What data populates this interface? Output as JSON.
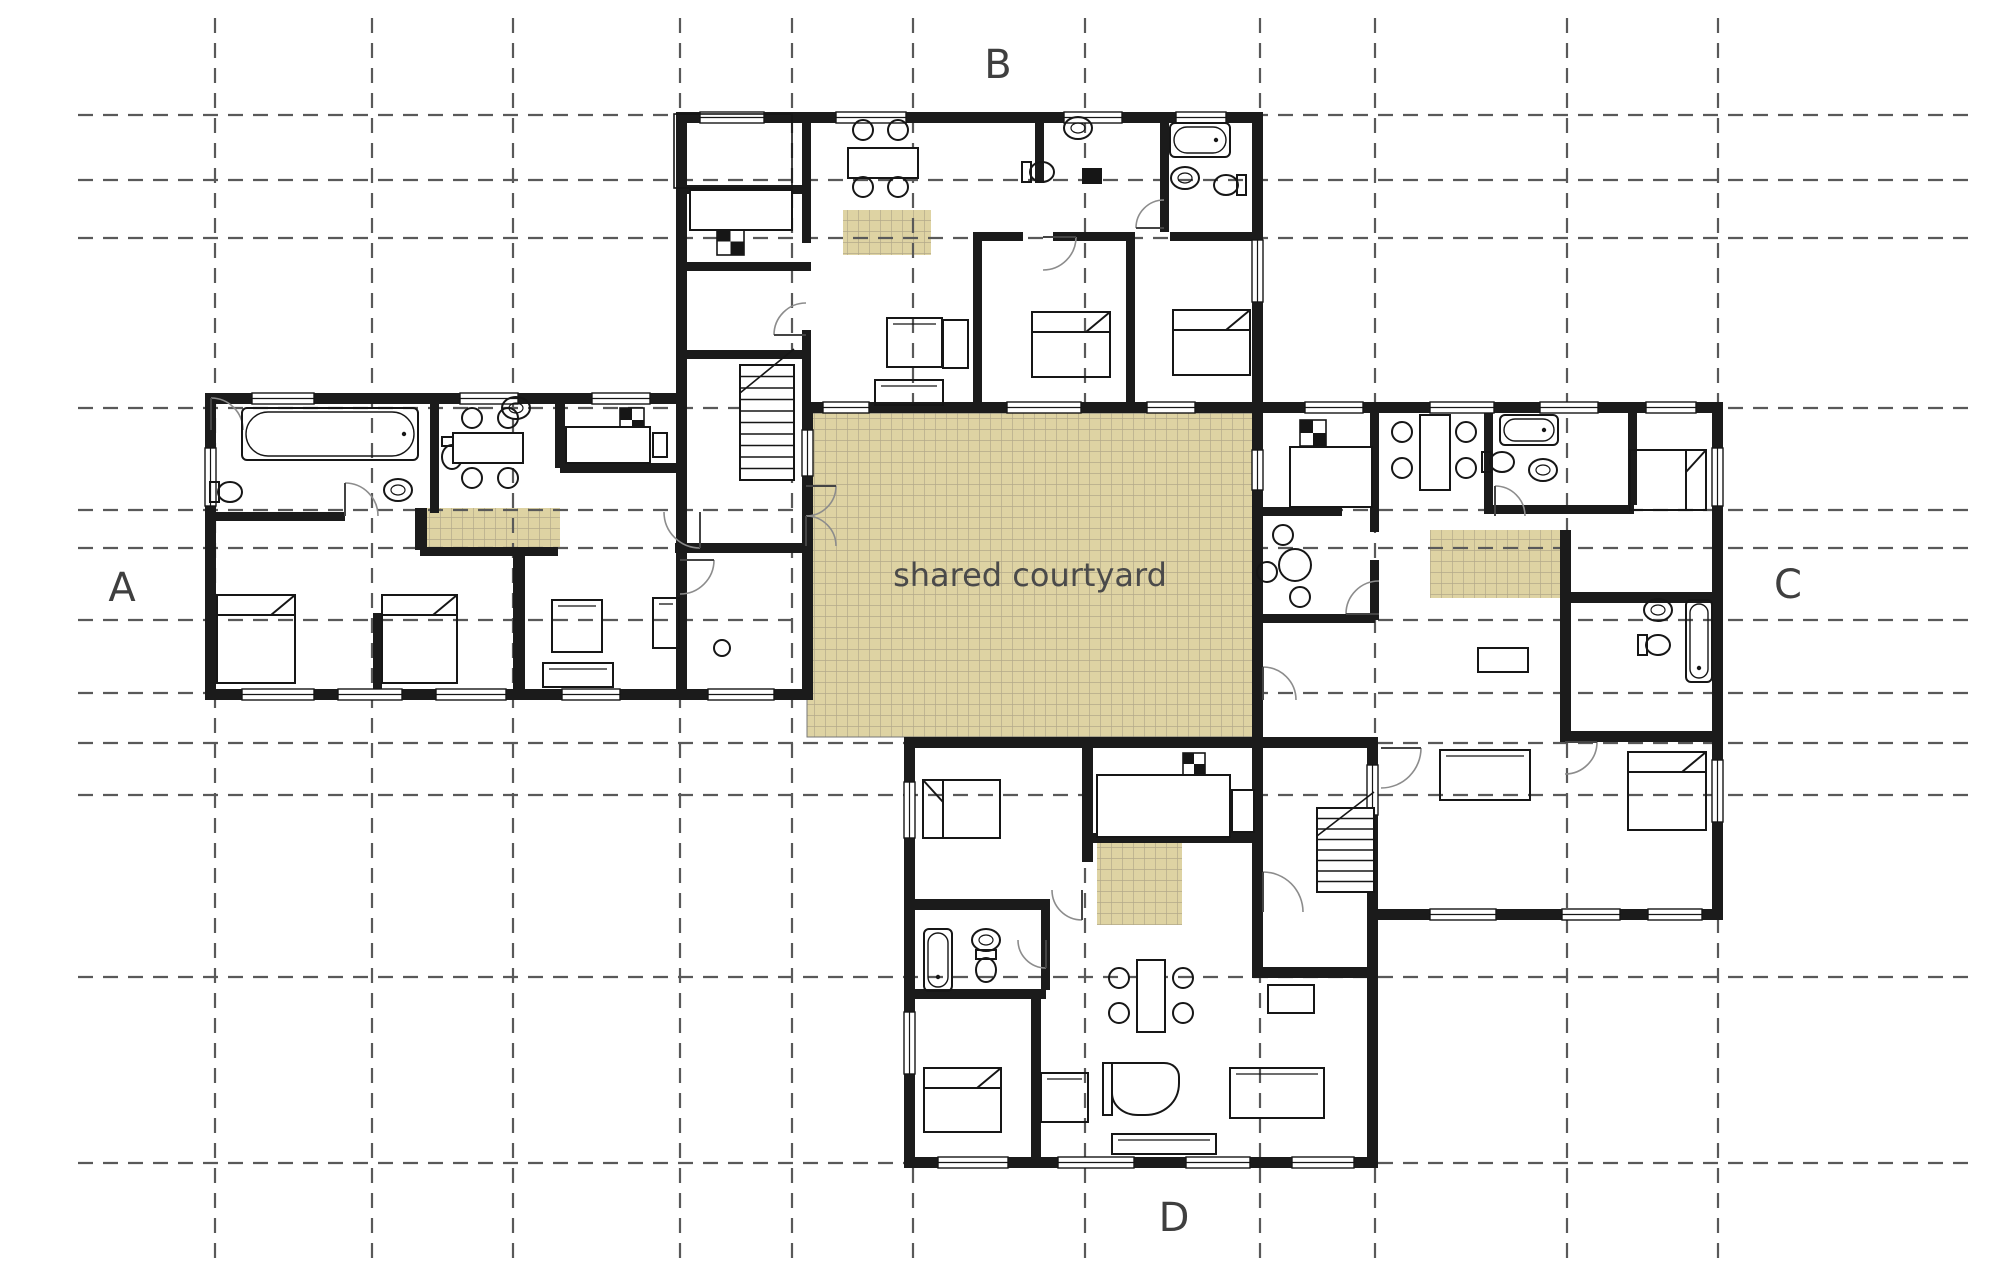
{
  "canvas": {
    "width": 2000,
    "height": 1284,
    "background": "#ffffff"
  },
  "palette": {
    "wall": "#1b1b1b",
    "furniture_line": "#161616",
    "grid_line": "#595959",
    "door_arc": "#8c8c8c",
    "tan_fill": "#ded3a3",
    "tan_line": "#b3a98a",
    "label_color": "#3f3f3f",
    "courtyard_text_color": "#4a4a4a"
  },
  "labels": {
    "courtyard": "shared courtyard",
    "unit_a": "A",
    "unit_b": "B",
    "unit_c": "C",
    "unit_d": "D"
  },
  "label_layout": [
    {
      "key": "unit_a",
      "x": 122,
      "y": 601,
      "size": 40
    },
    {
      "key": "unit_b",
      "x": 998,
      "y": 78,
      "size": 40
    },
    {
      "key": "unit_c",
      "x": 1788,
      "y": 598,
      "size": 40
    },
    {
      "key": "unit_d",
      "x": 1174,
      "y": 1231,
      "size": 40
    }
  ],
  "courtyard": {
    "x": 807,
    "y": 413,
    "w": 446,
    "h": 324,
    "label_x": 1030,
    "label_y": 586,
    "font_size": 32
  },
  "grid": {
    "verticals": [
      215,
      372,
      513,
      680,
      792,
      913,
      1085,
      1260,
      1375,
      1567,
      1718
    ],
    "horizontals": [
      115,
      180,
      238,
      408,
      510,
      548,
      620,
      693,
      743,
      795,
      977,
      1163
    ],
    "v_y1": 18,
    "v_y2": 1268,
    "h_x1": 78,
    "h_x2": 1972,
    "dash": "15 10",
    "width": 2.2
  },
  "terrace_patches": [
    [
      420,
      508,
      140,
      40
    ],
    [
      843,
      210,
      88,
      45
    ],
    [
      1430,
      530,
      130,
      68
    ],
    [
      1097,
      842,
      85,
      83
    ]
  ],
  "walls": [
    [
      205,
      393,
      482,
      11
    ],
    [
      205,
      393,
      11,
      307
    ],
    [
      205,
      689,
      608,
      11
    ],
    [
      676,
      112,
      11,
      588
    ],
    [
      676,
      112,
      587,
      11
    ],
    [
      1252,
      112,
      11,
      302
    ],
    [
      802,
      402,
      461,
      11
    ],
    [
      802,
      402,
      11,
      298
    ],
    [
      1252,
      402,
      471,
      11
    ],
    [
      1712,
      402,
      11,
      518
    ],
    [
      1252,
      402,
      11,
      346
    ],
    [
      904,
      737,
      474,
      11
    ],
    [
      1367,
      737,
      11,
      431
    ],
    [
      904,
      737,
      11,
      431
    ],
    [
      904,
      1157,
      474,
      11
    ],
    [
      1370,
      909,
      353,
      11
    ],
    [
      1252,
      967,
      126,
      11
    ],
    [
      1252,
      737,
      11,
      230
    ],
    [
      430,
      393,
      9,
      120
    ],
    [
      555,
      393,
      10,
      75
    ],
    [
      211,
      512,
      134,
      9
    ],
    [
      415,
      508,
      12,
      42
    ],
    [
      420,
      547,
      138,
      9
    ],
    [
      560,
      463,
      116,
      10
    ],
    [
      373,
      613,
      9,
      77
    ],
    [
      513,
      548,
      12,
      141
    ],
    [
      675,
      543,
      131,
      10
    ],
    [
      802,
      123,
      9,
      120
    ],
    [
      802,
      330,
      9,
      83
    ],
    [
      676,
      185,
      131,
      9
    ],
    [
      676,
      262,
      135,
      9
    ],
    [
      676,
      350,
      135,
      9
    ],
    [
      973,
      232,
      9,
      181
    ],
    [
      1126,
      232,
      9,
      181
    ],
    [
      973,
      232,
      50,
      9
    ],
    [
      1053,
      232,
      80,
      9
    ],
    [
      1170,
      232,
      82,
      9
    ],
    [
      1035,
      123,
      9,
      60
    ],
    [
      1160,
      123,
      9,
      109
    ],
    [
      1370,
      402,
      9,
      130
    ],
    [
      1370,
      560,
      9,
      60
    ],
    [
      1252,
      507,
      90,
      9
    ],
    [
      1252,
      614,
      123,
      9
    ],
    [
      1484,
      402,
      9,
      110
    ],
    [
      1484,
      505,
      150,
      9
    ],
    [
      1628,
      402,
      9,
      103
    ],
    [
      1560,
      530,
      11,
      72
    ],
    [
      1560,
      592,
      152,
      11
    ],
    [
      1560,
      592,
      11,
      150
    ],
    [
      1560,
      731,
      152,
      11
    ],
    [
      904,
      899,
      142,
      11
    ],
    [
      1041,
      899,
      9,
      91
    ],
    [
      904,
      989,
      142,
      10
    ],
    [
      1082,
      742,
      11,
      120
    ],
    [
      1085,
      833,
      168,
      10
    ],
    [
      1031,
      989,
      10,
      179
    ]
  ],
  "windows": [
    [
      252,
      393,
      62,
      11
    ],
    [
      460,
      393,
      58,
      11
    ],
    [
      592,
      393,
      58,
      11
    ],
    [
      205,
      448,
      11,
      58
    ],
    [
      242,
      689,
      72,
      11
    ],
    [
      338,
      689,
      64,
      11
    ],
    [
      436,
      689,
      70,
      11
    ],
    [
      562,
      689,
      58,
      11
    ],
    [
      708,
      689,
      66,
      11
    ],
    [
      700,
      112,
      64,
      11
    ],
    [
      836,
      112,
      70,
      11
    ],
    [
      1064,
      112,
      58,
      11
    ],
    [
      1176,
      112,
      50,
      11
    ],
    [
      1252,
      240,
      11,
      62
    ],
    [
      823,
      402,
      46,
      11
    ],
    [
      1007,
      402,
      74,
      11
    ],
    [
      1147,
      402,
      48,
      11
    ],
    [
      802,
      430,
      11,
      46
    ],
    [
      1252,
      450,
      11,
      40
    ],
    [
      1305,
      402,
      58,
      11
    ],
    [
      1430,
      402,
      64,
      11
    ],
    [
      1540,
      402,
      58,
      11
    ],
    [
      1646,
      402,
      50,
      11
    ],
    [
      1712,
      448,
      11,
      58
    ],
    [
      1712,
      760,
      11,
      62
    ],
    [
      1430,
      909,
      66,
      11
    ],
    [
      1562,
      909,
      58,
      11
    ],
    [
      1648,
      909,
      54,
      11
    ],
    [
      938,
      1157,
      70,
      11
    ],
    [
      1058,
      1157,
      76,
      11
    ],
    [
      1186,
      1157,
      64,
      11
    ],
    [
      1292,
      1157,
      62,
      11
    ],
    [
      904,
      782,
      11,
      56
    ],
    [
      904,
      1012,
      11,
      62
    ],
    [
      1367,
      765,
      11,
      50
    ]
  ],
  "doors": [
    [
      806,
      486,
      30,
      0,
      90
    ],
    [
      806,
      546,
      30,
      270,
      360
    ],
    [
      700,
      512,
      36,
      90,
      180
    ],
    [
      345,
      516,
      33,
      270,
      360
    ],
    [
      806,
      335,
      32,
      180,
      270
    ],
    [
      1043,
      237,
      33,
      0,
      90
    ],
    [
      1164,
      228,
      28,
      180,
      270
    ],
    [
      211,
      430,
      32,
      270,
      360
    ],
    [
      1263,
      700,
      33,
      270,
      360
    ],
    [
      1379,
      614,
      33,
      180,
      270
    ],
    [
      1495,
      516,
      30,
      270,
      360
    ],
    [
      1381,
      748,
      40,
      0,
      90
    ],
    [
      1263,
      912,
      40,
      270,
      360
    ],
    [
      1046,
      940,
      28,
      90,
      180
    ],
    [
      1082,
      890,
      30,
      90,
      180
    ],
    [
      1565,
      742,
      32,
      0,
      90
    ],
    [
      680,
      560,
      34,
      0,
      90
    ]
  ],
  "stairs": [
    {
      "x": 740,
      "y": 365,
      "w": 54,
      "h": 115,
      "treads": 9,
      "diag": true
    },
    {
      "x": 1317,
      "y": 808,
      "w": 57,
      "h": 84,
      "treads": 7,
      "diag": true
    }
  ],
  "porches": [
    [
      674,
      114,
      118,
      74
    ]
  ],
  "furniture": {
    "beds": [
      [
        217,
        595,
        78,
        88,
        "N"
      ],
      [
        382,
        595,
        75,
        88,
        "N"
      ],
      [
        1032,
        312,
        78,
        65,
        "N"
      ],
      [
        1173,
        310,
        77,
        65,
        "N"
      ],
      [
        1630,
        450,
        76,
        60,
        "E"
      ],
      [
        1628,
        752,
        78,
        78,
        "N"
      ],
      [
        923,
        780,
        77,
        58,
        "W"
      ],
      [
        924,
        1068,
        77,
        64,
        "N"
      ]
    ],
    "tubs": [
      [
        242,
        408,
        176,
        52
      ],
      [
        1170,
        123,
        60,
        34
      ],
      [
        1500,
        415,
        58,
        30
      ],
      [
        1686,
        600,
        26,
        82
      ],
      [
        924,
        929,
        28,
        62
      ]
    ],
    "toilets": [
      [
        228,
        492,
        "E"
      ],
      [
        1040,
        172,
        "E"
      ],
      [
        1228,
        185,
        "W"
      ],
      [
        1500,
        462,
        "E"
      ],
      [
        1656,
        645,
        "E"
      ],
      [
        986,
        968,
        "S"
      ],
      [
        452,
        455,
        "S"
      ]
    ],
    "sinks": [
      [
        398,
        490
      ],
      [
        1078,
        128
      ],
      [
        1185,
        178
      ],
      [
        1543,
        470
      ],
      [
        1658,
        610
      ],
      [
        986,
        940
      ],
      [
        516,
        408
      ]
    ],
    "stoves": [
      [
        620,
        408,
        24
      ],
      [
        717,
        228,
        27
      ],
      [
        1300,
        420,
        26
      ],
      [
        1183,
        753,
        22
      ]
    ],
    "counters": [
      [
        566,
        427,
        84,
        36
      ],
      [
        653,
        433,
        14,
        24
      ],
      [
        690,
        190,
        102,
        40
      ],
      [
        1290,
        447,
        82,
        60
      ],
      [
        1097,
        775,
        133,
        62
      ],
      [
        1232,
        790,
        22,
        42
      ]
    ],
    "tables": [
      [
        453,
        433,
        70,
        30
      ],
      [
        848,
        148,
        70,
        30
      ],
      [
        1137,
        960,
        28,
        72
      ],
      [
        1420,
        415,
        30,
        75
      ],
      [
        1478,
        648,
        50,
        24
      ],
      [
        1268,
        985,
        46,
        28
      ],
      [
        943,
        320,
        25,
        48
      ]
    ],
    "chairs": [
      [
        472,
        418
      ],
      [
        508,
        418
      ],
      [
        472,
        478
      ],
      [
        508,
        478
      ],
      [
        863,
        130
      ],
      [
        898,
        130
      ],
      [
        863,
        187
      ],
      [
        898,
        187
      ],
      [
        1402,
        432
      ],
      [
        1402,
        468
      ],
      [
        1466,
        432
      ],
      [
        1466,
        468
      ],
      [
        1283,
        535
      ],
      [
        1267,
        572
      ],
      [
        1300,
        597
      ],
      [
        1119,
        978
      ],
      [
        1119,
        1013
      ],
      [
        1183,
        978
      ],
      [
        1183,
        1013
      ]
    ],
    "round_tables": [
      [
        1295,
        565,
        16
      ]
    ],
    "circles": [
      [
        722,
        648,
        8
      ]
    ],
    "sofas": [
      [
        887,
        318,
        55,
        49
      ],
      [
        875,
        380,
        68,
        25
      ],
      [
        552,
        600,
        50,
        52
      ],
      [
        543,
        663,
        70,
        24
      ],
      [
        653,
        598,
        26,
        50
      ],
      [
        1440,
        750,
        90,
        50
      ],
      [
        1230,
        1068,
        94,
        50
      ],
      [
        1041,
        1073,
        47,
        49
      ],
      [
        1112,
        1134,
        104,
        20
      ]
    ],
    "piano": [
      1112,
      1063
    ],
    "solid_fixtures": [
      [
        1082,
        168,
        20,
        16
      ]
    ]
  }
}
